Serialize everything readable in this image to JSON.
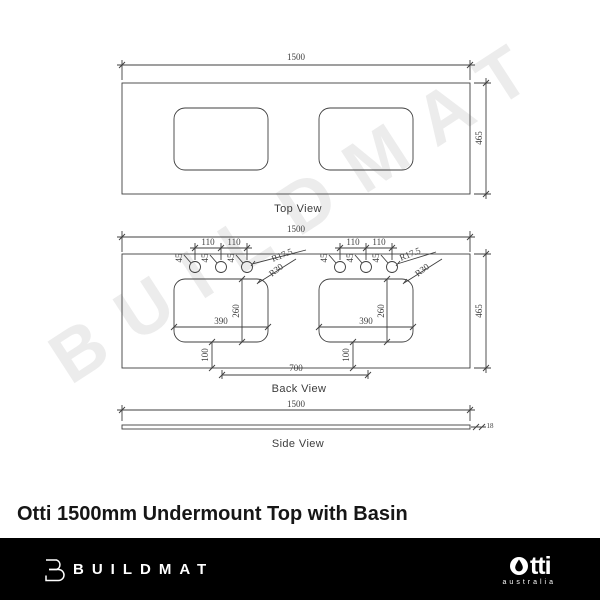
{
  "watermark": {
    "text": "BUILDMAT"
  },
  "title": "Otti 1500mm Undermount Top with Basin",
  "views": {
    "top": {
      "label": "Top View"
    },
    "back": {
      "label": "Back View"
    },
    "side": {
      "label": "Side View"
    }
  },
  "dims": {
    "overall_width": "1500",
    "overall_depth": "465",
    "thickness": "18",
    "tap_hole_spacing": "110",
    "tap_hole_edge_offset": "45",
    "tap_hole_radius": "R17.5",
    "basin_corner_radius": "R30",
    "basin_cutout_width": "390",
    "basin_cutout_depth": "260",
    "basin_front_offset": "100",
    "basin_centres_spacing": "700"
  },
  "footer": {
    "brand": "BUILDMAT",
    "otti_wordmark_tail": "tti",
    "otti_subtext": "australia"
  },
  "colors": {
    "line": "#3f3f3f",
    "footer_background": "#000000",
    "watermark": "#ececec",
    "title_text": "#161616"
  }
}
